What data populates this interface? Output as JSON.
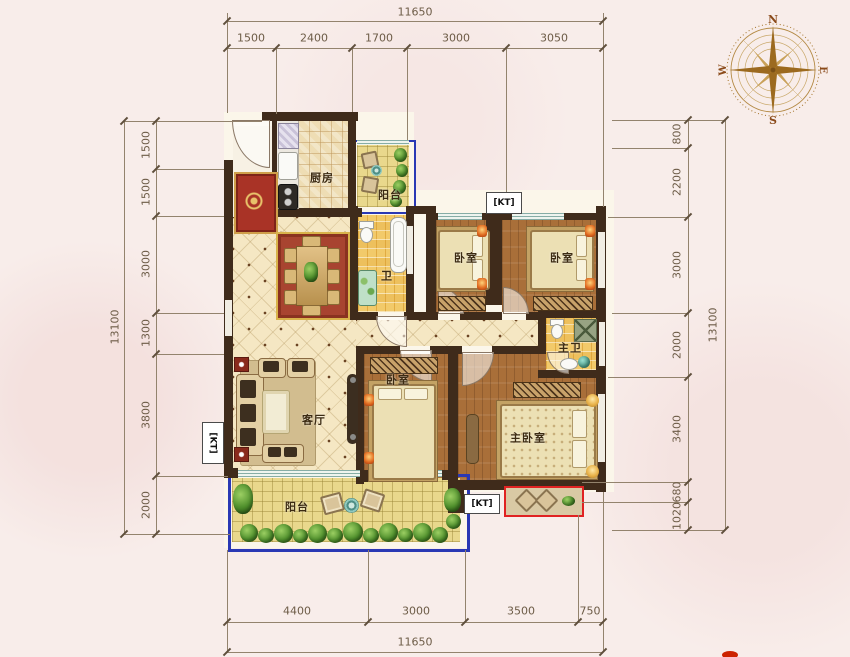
{
  "plan_title": "residential-floor-plan",
  "compass": {
    "n": "N",
    "e": "E",
    "s": "S",
    "w": "W"
  },
  "rooms": {
    "kitchen": "厨房",
    "balcony_top": "阳台",
    "bath": "卫",
    "bedroom1": "卧室",
    "bedroom2": "卧室",
    "master_bath": "主卫",
    "living": "客厅",
    "bedroom3": "卧室",
    "master_bedroom": "主卧室",
    "balcony_bottom": "阳台"
  },
  "kt": {
    "top": "[KT]",
    "left": "[KT]",
    "bottom": "[KT]"
  },
  "dims": {
    "top": {
      "total": "11650",
      "segments": [
        "1500",
        "2400",
        "1700",
        "3000",
        "3050"
      ]
    },
    "bottom": {
      "total": "11650",
      "segments": [
        "4400",
        "3000",
        "3500",
        "750"
      ]
    },
    "left": {
      "total": "13100",
      "segments": [
        "1500",
        "1500",
        "3000",
        "1300",
        "3800",
        "2000"
      ]
    },
    "right": {
      "total": "13100",
      "segments": [
        "800",
        "2200",
        "3000",
        "2000",
        "3400",
        "680",
        "1020"
      ]
    }
  },
  "colors": {
    "wall": "#3f2b1b",
    "balcony_border": "#2a38b4",
    "ac_platform_outline": "#e02222",
    "compass_brown": "#9c6a1f",
    "dim_text": "#6d5c47"
  }
}
